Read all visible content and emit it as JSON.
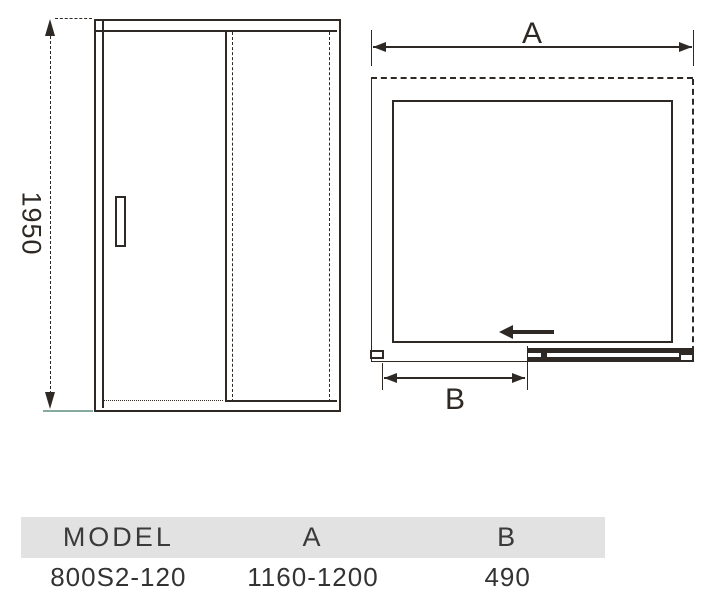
{
  "drawing": {
    "front_view": {
      "height_dim": "1950"
    },
    "plan_view": {
      "width_dim_label": "A",
      "door_dim_label": "B"
    }
  },
  "table": {
    "headers": {
      "model": "MODEL",
      "a": "A",
      "b": "B"
    },
    "row": {
      "model": "800S2-120",
      "a": "1160-1200",
      "b": "490"
    }
  },
  "colors": {
    "line": "#2e2924",
    "header_bg": "#e2e2e2",
    "ground_line": "#86aaa0"
  }
}
